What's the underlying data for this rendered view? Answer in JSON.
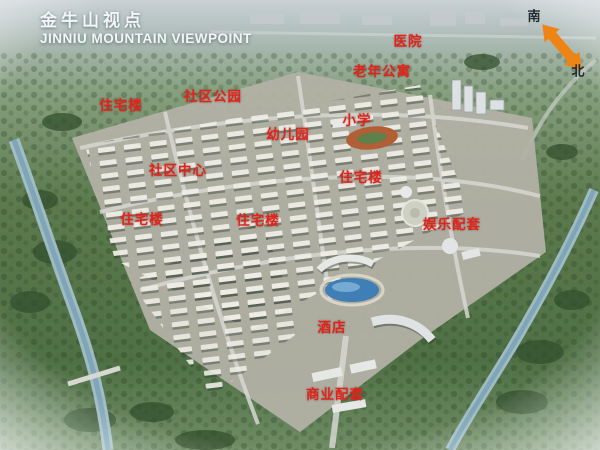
{
  "title": {
    "cn": "金牛山视点",
    "en": "JINNIU MOUNTAIN VIEWPOINT"
  },
  "compass": {
    "south": "南",
    "north": "北"
  },
  "map_labels": [
    {
      "text": "医院",
      "x": 408,
      "y": 40
    },
    {
      "text": "老年公寓",
      "x": 382,
      "y": 70
    },
    {
      "text": "社区公园",
      "x": 213,
      "y": 95
    },
    {
      "text": "住宅楼",
      "x": 121,
      "y": 104
    },
    {
      "text": "小学",
      "x": 357,
      "y": 119
    },
    {
      "text": "幼儿园",
      "x": 288,
      "y": 133
    },
    {
      "text": "社区中心",
      "x": 178,
      "y": 169
    },
    {
      "text": "住宅楼",
      "x": 361,
      "y": 176
    },
    {
      "text": "住宅楼",
      "x": 142,
      "y": 218
    },
    {
      "text": "住宅楼",
      "x": 258,
      "y": 219
    },
    {
      "text": "娱乐配套",
      "x": 452,
      "y": 223
    },
    {
      "text": "酒店",
      "x": 332,
      "y": 326
    },
    {
      "text": "商业配套",
      "x": 335,
      "y": 393
    }
  ],
  "colors": {
    "label_red": "#e3231a",
    "arrow_orange": "#ef8414",
    "title_white": "#f3f6f8",
    "compass_text": "#141c24"
  }
}
